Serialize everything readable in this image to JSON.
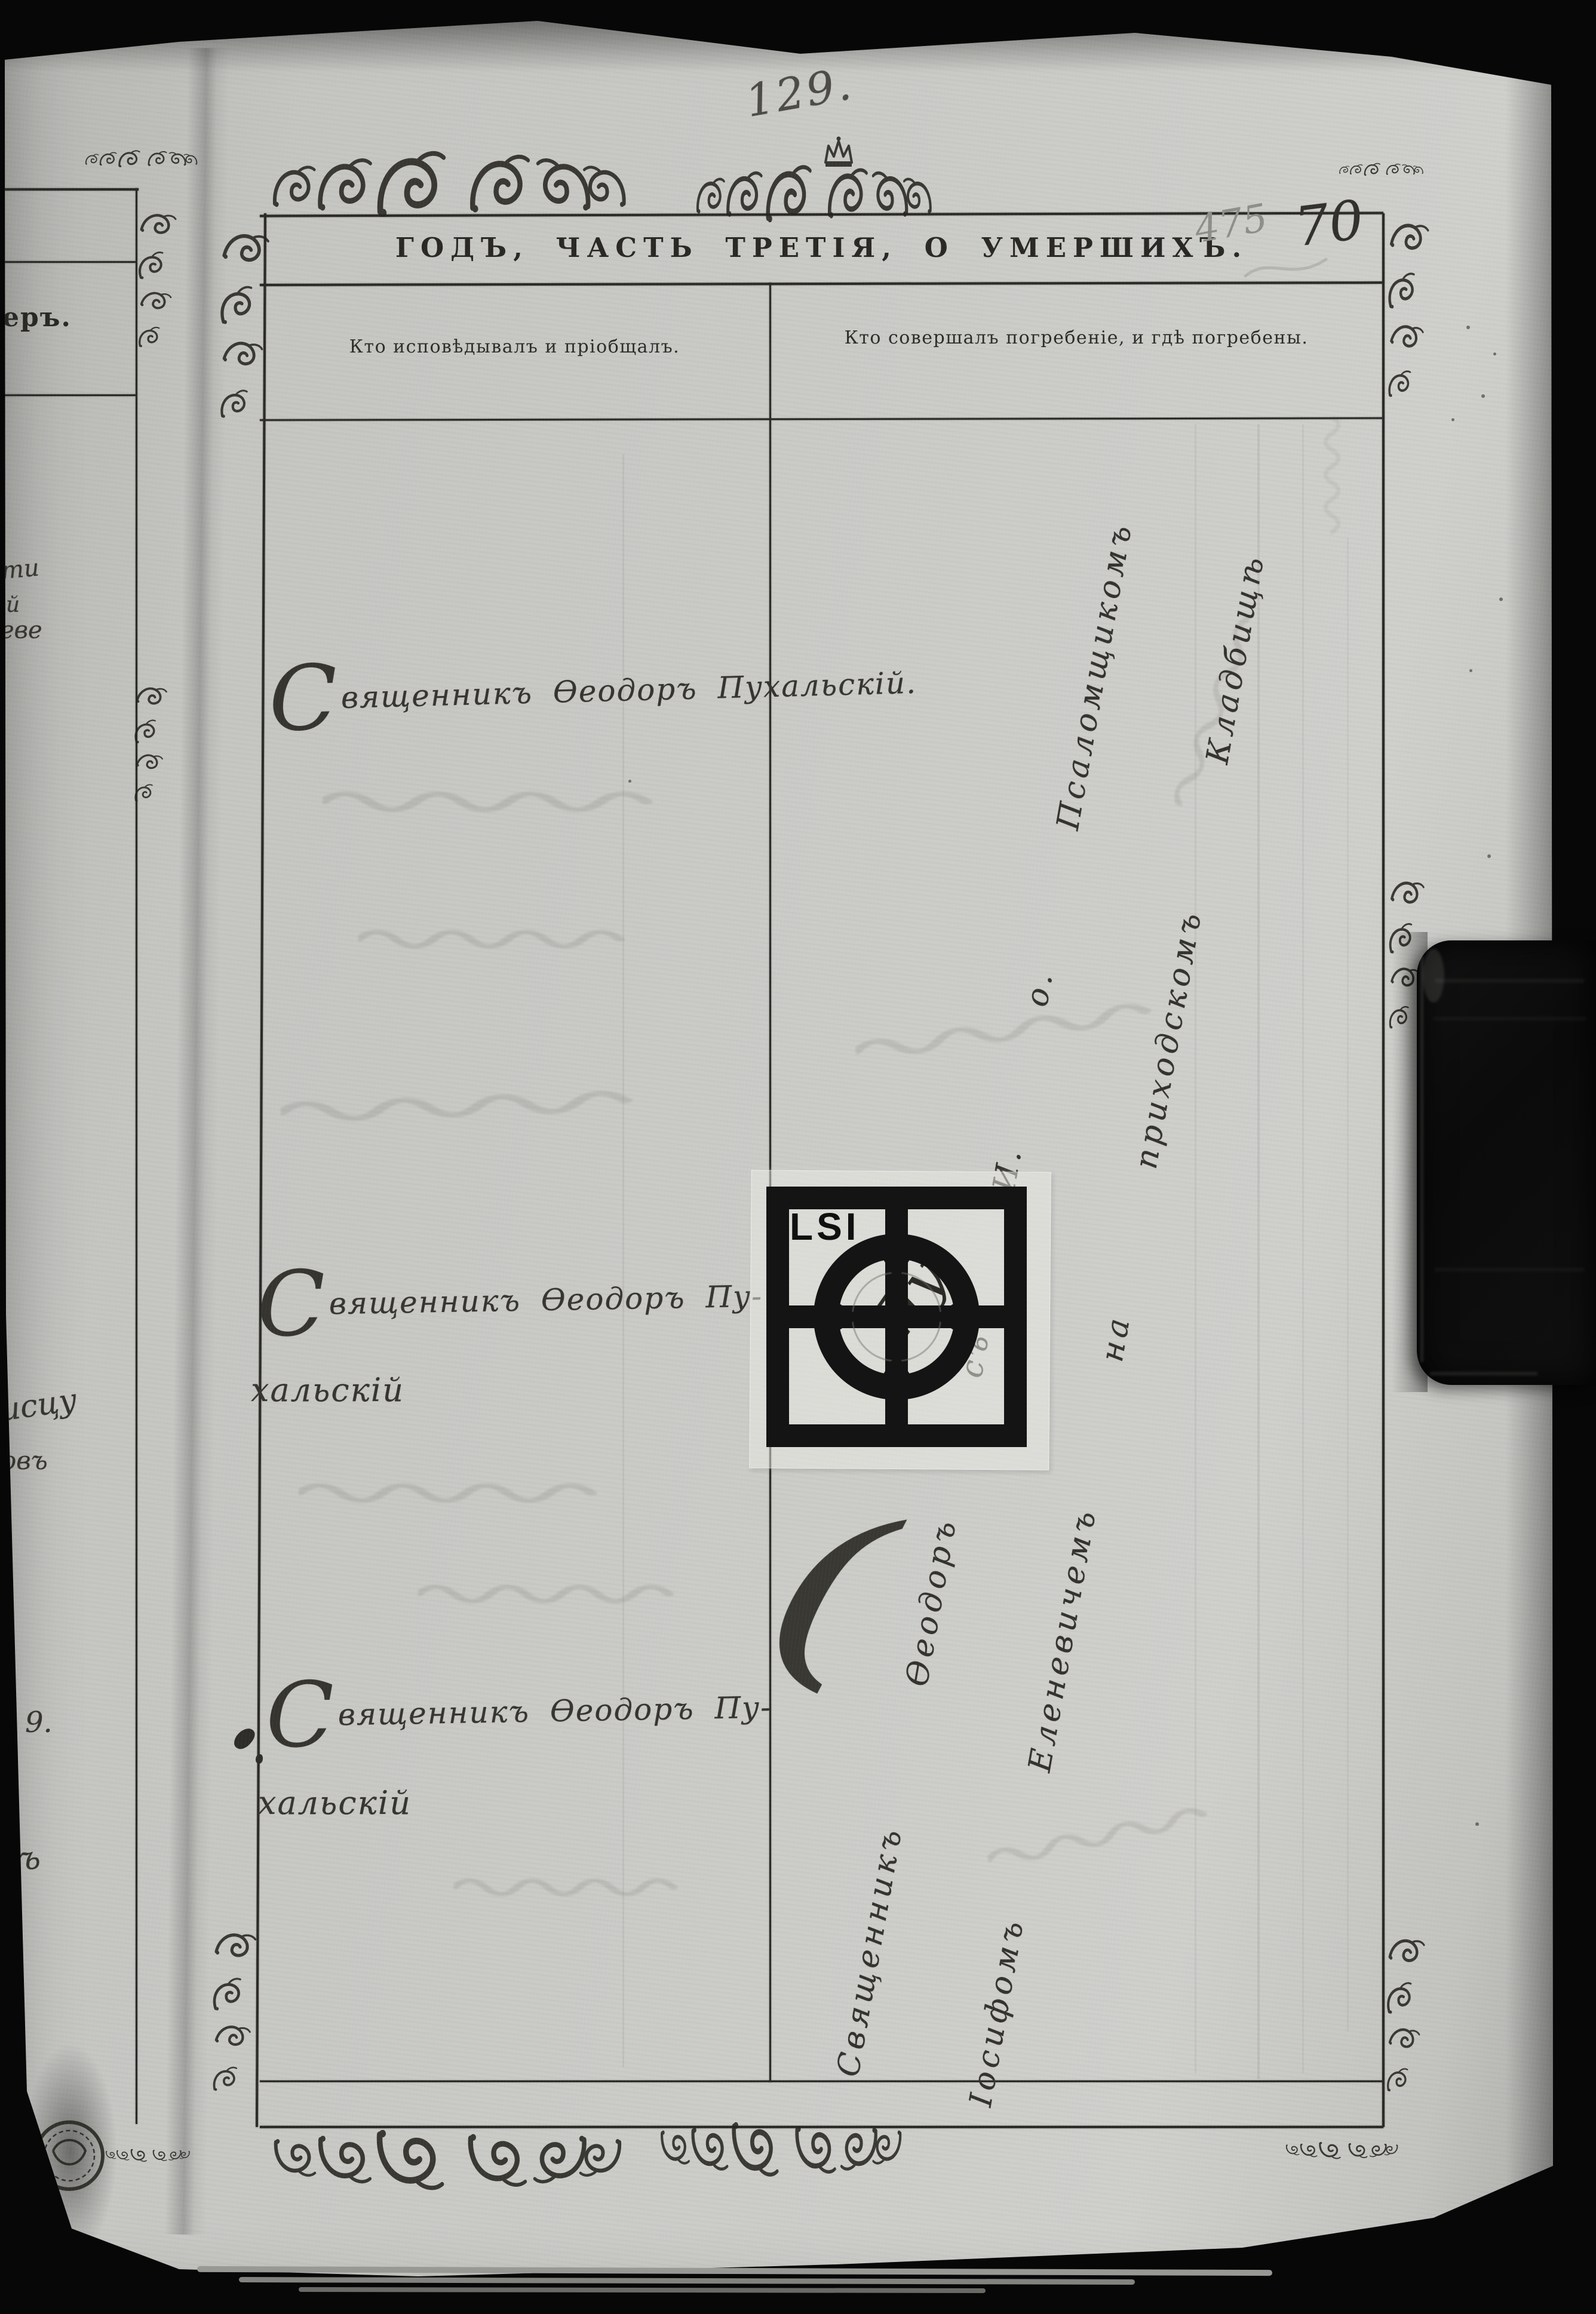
{
  "document": {
    "page_number": "129.",
    "folio_number_pencil": "475",
    "folio_number_ink": "70",
    "title": "ГОДЪ, ЧАСТЬ ТРЕТІЯ, О УМЕРШИХЪ.",
    "columns": {
      "confession": "Кто исповѣдывалъ и пріобщалъ.",
      "burial": "Кто совершалъ погребеніе, и гдѣ погребены."
    },
    "entries": [
      {
        "lines": [
          "Священникъ Ѳеодоръ Пухальскій."
        ]
      },
      {
        "lines": [
          "Священникъ Ѳеодоръ Пу-",
          "хальскій"
        ]
      },
      {
        "lines": [
          "Священникъ Ѳеодоръ Пу-",
          "хальскій"
        ]
      }
    ],
    "burial_notes": [
      "Священникъ Ѳеодоръ съ И. о. Псаломщикомъ",
      "Іосифомъ Еленевичемъ на приходскомъ Кладбищѣ"
    ],
    "center_overwrite": "Пу",
    "underlying_page_fragment": "еръ.",
    "margin_fragments": [
      "ти",
      "й",
      "еве",
      "исцу",
      "овъ",
      "9.",
      "въ"
    ]
  },
  "calibration_target": {
    "label": "LSI"
  }
}
